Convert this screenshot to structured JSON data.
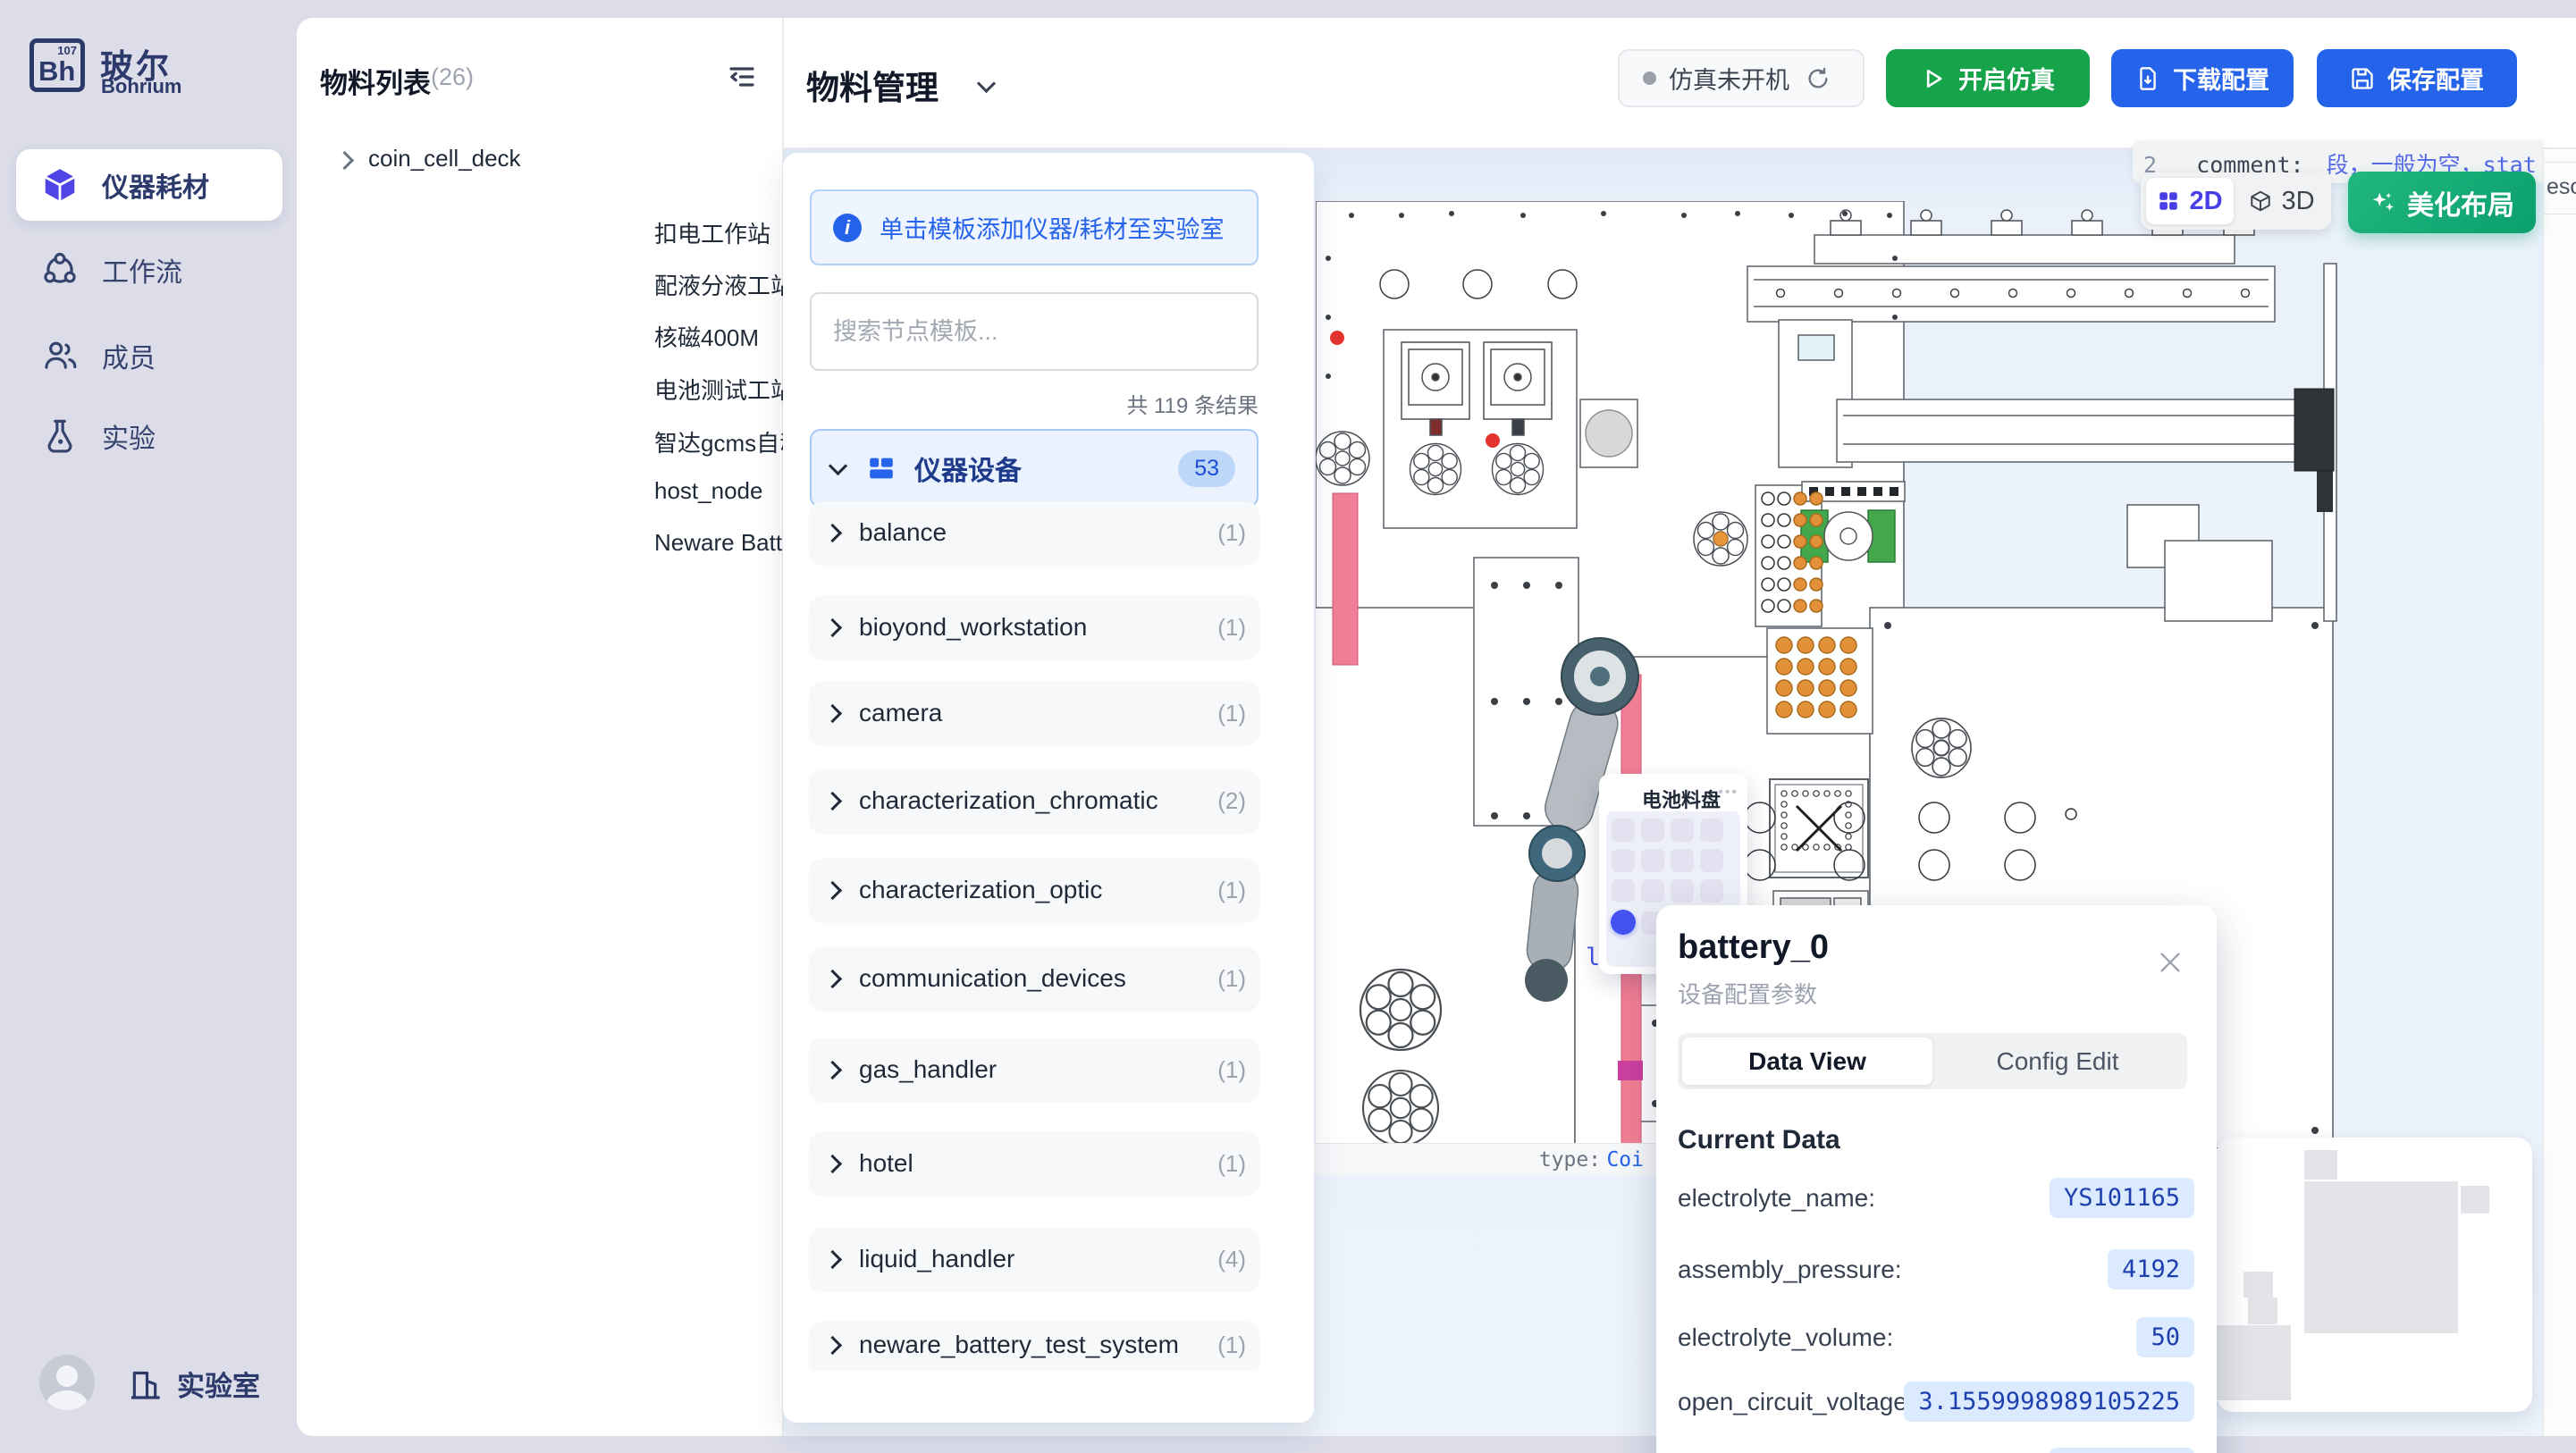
{
  "brand": {
    "logo_abbr": "Bh",
    "logo_num": "107",
    "name_zh": "玻尔",
    "name_en": "Bohrium"
  },
  "sidebar": {
    "items": [
      {
        "label": "仪器耗材"
      },
      {
        "label": "工作流"
      },
      {
        "label": "成员"
      },
      {
        "label": "实验"
      }
    ],
    "footer_label": "实验室"
  },
  "materials": {
    "title": "物料列表",
    "count": "(26)",
    "items": [
      "coin_cell_deck",
      "扣电工作站",
      "配液分液工站",
      "核磁400M",
      "电池测试工站",
      "智达gcms自动进样",
      "host_node",
      "Neware Battery Test System"
    ]
  },
  "header": {
    "title": "物料管理",
    "status_label": "仿真未开机",
    "start_button": "开启仿真",
    "download_button": "下载配置",
    "save_button": "保存配置"
  },
  "template_panel": {
    "banner": "单击模板添加仪器/耗材至实验室",
    "search_placeholder": "搜索节点模板...",
    "results": "共 119 条结果",
    "group_label": "仪器设备",
    "group_badge": "53",
    "categories": [
      {
        "name": "balance",
        "count": "(1)"
      },
      {
        "name": "bioyond_workstation",
        "count": "(1)"
      },
      {
        "name": "camera",
        "count": "(1)"
      },
      {
        "name": "characterization_chromatic",
        "count": "(2)"
      },
      {
        "name": "characterization_optic",
        "count": "(1)"
      },
      {
        "name": "communication_devices",
        "count": "(1)"
      },
      {
        "name": "gas_handler",
        "count": "(1)"
      },
      {
        "name": "hotel",
        "count": "(1)"
      },
      {
        "name": "liquid_handler",
        "count": "(4)"
      },
      {
        "name": "neware_battery_test_system",
        "count": "(1)"
      }
    ]
  },
  "canvas": {
    "toggle_2d": "2D",
    "toggle_3d": "3D",
    "beautify_button": "美化布局",
    "code_tooltip": {
      "line_no": "2",
      "key": "_comment:",
      "value": "段，一般为空，stat",
      "value_line2": "法化固定"
    },
    "edge_text": "esou",
    "type_label": "type:",
    "type_value": "Coi",
    "plate_fragment": "late"
  },
  "tray_popup": {
    "title": "电池料盘",
    "menu": "•••"
  },
  "detail_popup": {
    "title": "battery_0",
    "subtitle": "设备配置参数",
    "tab_data": "Data View",
    "tab_config": "Config Edit",
    "section_title": "Current Data",
    "fields": [
      {
        "label": "electrolyte_name:",
        "value": "YS101165"
      },
      {
        "label": "assembly_pressure:",
        "value": "4192"
      },
      {
        "label": "electrolyte_volume:",
        "value": "50"
      },
      {
        "label": "open_circuit_voltage:",
        "value": "3.1559998989105225"
      },
      {
        "label": "data_electrolyte_code:",
        "value": "LG000014"
      }
    ]
  }
}
